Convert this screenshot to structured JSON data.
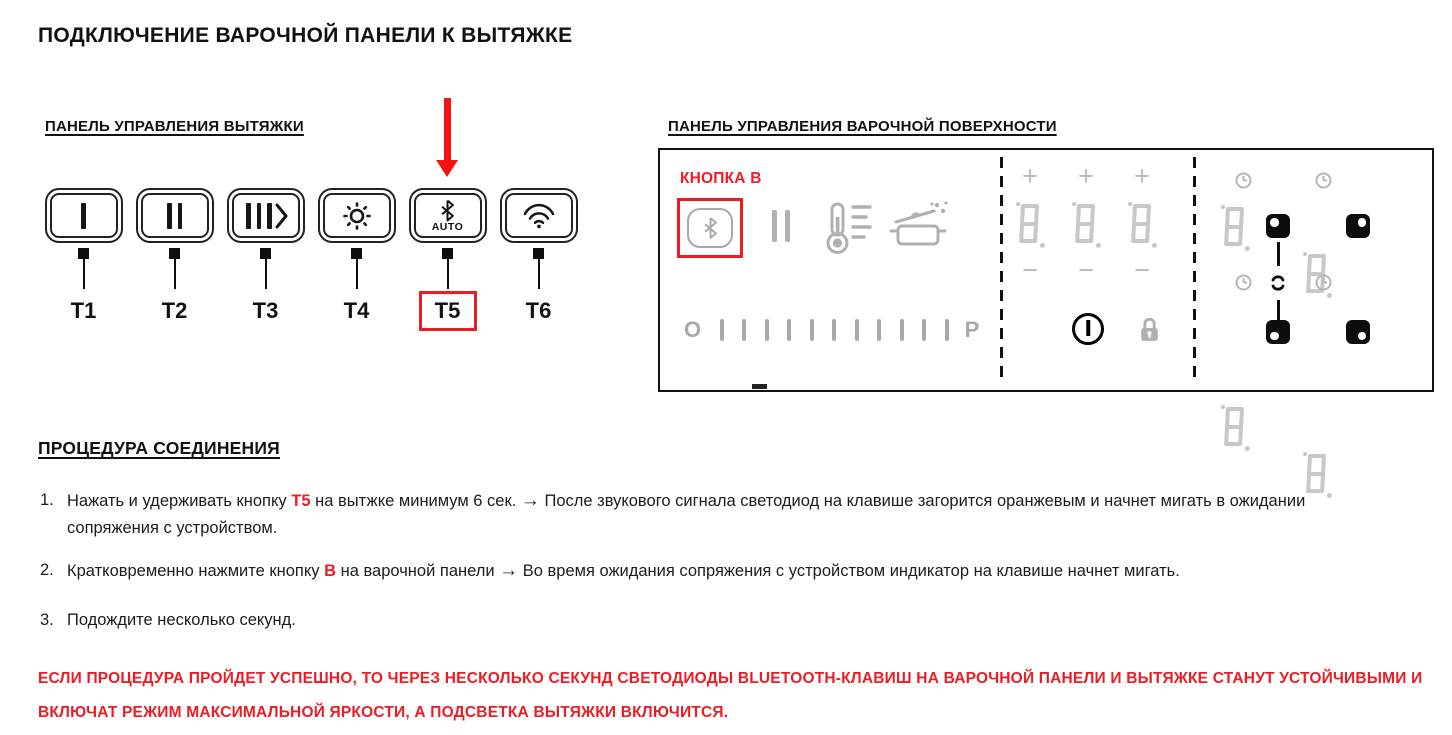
{
  "page": {
    "title": "ПОДКЛЮЧЕНИЕ ВАРОЧНОЙ ПАНЕЛИ К ВЫТЯЖКЕ"
  },
  "colors": {
    "accent_red": "#ed1c24",
    "icon_grey": "#adadad",
    "segment_grey": "#c8c8c8",
    "text_black": "#1c1c1c"
  },
  "hood_panel": {
    "title": "ПАНЕЛЬ УПРАВЛЕНИЯ ВЫТЯЖКИ",
    "buttons": [
      {
        "label": "T1",
        "icon": "fan-speed-1"
      },
      {
        "label": "T2",
        "icon": "fan-speed-2"
      },
      {
        "label": "T3",
        "icon": "fan-speed-3-boost"
      },
      {
        "label": "T4",
        "icon": "light"
      },
      {
        "label": "T5",
        "icon": "bluetooth-auto",
        "sub_label": "AUTO",
        "highlighted": true
      },
      {
        "label": "T6",
        "icon": "wifi"
      }
    ]
  },
  "hob_panel": {
    "title": "ПАНЕЛЬ УПРАВЛЕНИЯ ВАРОЧНОЙ ПОВЕРХНОСТИ",
    "button_b_label": "КНОПКА B",
    "power_scale": {
      "start": "O",
      "end": "P",
      "bars": 11
    },
    "zone_display": {
      "plus": "+",
      "minus": "−",
      "digit": "8."
    },
    "icons": [
      "bluetooth",
      "pause",
      "temperature-levels",
      "boil-detect",
      "power",
      "lock",
      "timer-clock",
      "bridge-link"
    ]
  },
  "procedure": {
    "title": "ПРОЦЕДУРА СОЕДИНЕНИЯ",
    "steps": [
      {
        "num": "1.",
        "pre": "Нажать и удерживать кнопку ",
        "key": "T5",
        "mid": " на вытжке минимум 6 сек.  ",
        "arrow": "→",
        "post": " После звукового сигнала светодиод на клавише загорится оранжевым и начнет мигать в ожидании сопряжения с устройством."
      },
      {
        "num": "2.",
        "pre": "Кратковременно нажмите кнопку ",
        "key": "B",
        "mid": " на варочной панели ",
        "arrow": "→",
        "post": " Во время ожидания сопряжения с устройством индикатор на клавише начнет мигать."
      },
      {
        "num": "3.",
        "pre": "Подождите несколько секунд.",
        "key": "",
        "mid": "",
        "arrow": "",
        "post": ""
      }
    ],
    "warning": "ЕСЛИ ПРОЦЕДУРА ПРОЙДЕТ УСПЕШНО, ТО ЧЕРЕЗ НЕСКОЛЬКО СЕКУНД СВЕТОДИОДЫ BLUETOOTH-КЛАВИШ НА ВАРОЧНОЙ ПАНЕЛИ И ВЫТЯЖКЕ СТАНУТ УСТОЙЧИВЫМИ И ВКЛЮЧАТ РЕЖИМ МАКСИМАЛЬНОЙ ЯРКОСТИ, А ПОДСВЕТКА ВЫТЯЖКИ ВКЛЮЧИТСЯ."
  }
}
